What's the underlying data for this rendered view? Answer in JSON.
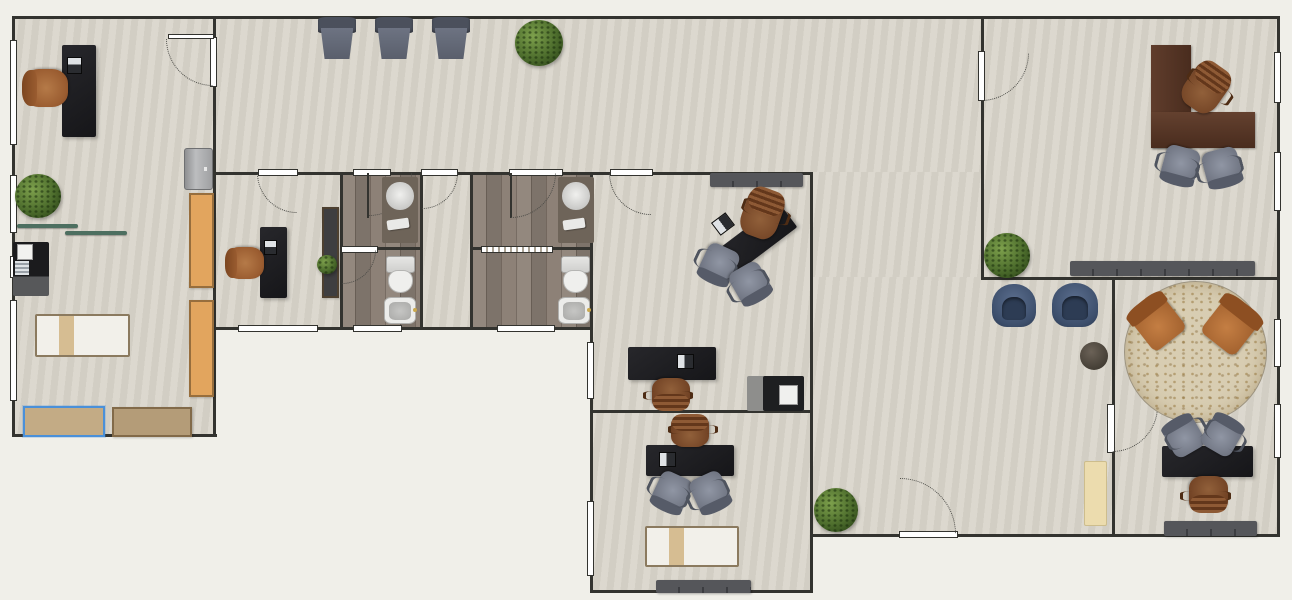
{
  "app": {
    "view": "floor-plan-2d"
  },
  "palette": {
    "exterior": "#f0efe9",
    "floor": "#d9d5cb",
    "bathroom_floor": "#8a7f76",
    "wall": "#33332f",
    "selection": "#4a90d9",
    "desk_black": "#1f1f22",
    "desk_wood": "#543325",
    "chair_cognac": "#9a5c30",
    "chair_gray": "#7d828e",
    "chair_blue": "#46587b",
    "plant_green": "#4c6c2c",
    "cabinet_orange": "#e2a55e",
    "cabinet_tan": "#b49c78"
  },
  "floorplan": {
    "canvas": {
      "w": 1292,
      "h": 600
    },
    "rooms": [
      {
        "n": "treatment-room",
        "x": 12,
        "y": 17,
        "w": 202,
        "h": 420,
        "floor": "default"
      },
      {
        "n": "hallway",
        "x": 214,
        "y": 17,
        "w": 767,
        "h": 156,
        "floor": "default"
      },
      {
        "n": "hallway-south",
        "x": 812,
        "y": 172,
        "w": 169,
        "h": 106,
        "floor": "default"
      },
      {
        "n": "waiting-area",
        "x": 812,
        "y": 277,
        "w": 300,
        "h": 258,
        "floor": "default"
      },
      {
        "n": "consultation-room",
        "x": 214,
        "y": 172,
        "w": 127,
        "h": 156,
        "floor": "default"
      },
      {
        "n": "bathroom-1",
        "x": 340,
        "y": 172,
        "w": 81,
        "h": 156,
        "floor": "wood"
      },
      {
        "n": "bathroom-lobby",
        "x": 420,
        "y": 172,
        "w": 51,
        "h": 156,
        "floor": "default"
      },
      {
        "n": "bathroom-2",
        "x": 471,
        "y": 172,
        "w": 120,
        "h": 156,
        "floor": "wood"
      },
      {
        "n": "office-center",
        "x": 590,
        "y": 172,
        "w": 221,
        "h": 239,
        "floor": "default"
      },
      {
        "n": "office-south",
        "x": 590,
        "y": 411,
        "w": 221,
        "h": 180,
        "floor": "default"
      },
      {
        "n": "office-northeast",
        "x": 981,
        "y": 19,
        "w": 297,
        "h": 259,
        "floor": "default"
      },
      {
        "n": "office-southeast",
        "x": 1112,
        "y": 277,
        "w": 166,
        "h": 258,
        "floor": "default"
      }
    ],
    "walls": [
      [
        12,
        16,
        1266,
        3
      ],
      [
        12,
        16,
        3,
        421
      ],
      [
        12,
        434,
        205,
        3
      ],
      [
        213,
        16,
        3,
        421
      ],
      [
        213,
        327,
        380,
        3
      ],
      [
        340,
        172,
        3,
        158
      ],
      [
        420,
        172,
        3,
        158
      ],
      [
        470,
        172,
        3,
        158
      ],
      [
        590,
        172,
        3,
        421
      ],
      [
        810,
        172,
        3,
        421
      ],
      [
        213,
        172,
        600,
        3
      ],
      [
        340,
        247,
        83,
        3
      ],
      [
        470,
        247,
        123,
        3
      ],
      [
        590,
        410,
        223,
        3
      ],
      [
        590,
        590,
        223,
        3
      ],
      [
        810,
        534,
        470,
        3
      ],
      [
        981,
        16,
        3,
        264
      ],
      [
        981,
        277,
        299,
        3
      ],
      [
        1112,
        277,
        3,
        260
      ],
      [
        1277,
        16,
        3,
        521
      ]
    ],
    "windows": [
      [
        10,
        40,
        7,
        105
      ],
      [
        10,
        175,
        7,
        58
      ],
      [
        10,
        256,
        7,
        22
      ],
      [
        10,
        300,
        7,
        101
      ],
      [
        238,
        325,
        80,
        7
      ],
      [
        353,
        325,
        49,
        7
      ],
      [
        497,
        325,
        58,
        7
      ],
      [
        587,
        342,
        7,
        57
      ],
      [
        587,
        501,
        7,
        75
      ],
      [
        1274,
        52,
        7,
        51
      ],
      [
        1274,
        152,
        7,
        59
      ],
      [
        1274,
        319,
        7,
        48
      ],
      [
        1274,
        404,
        7,
        54
      ]
    ],
    "doors": [
      {
        "n": "door-treatment-room",
        "bar": [
          210,
          37,
          7,
          50
        ],
        "leaf": [
          168,
          34,
          46,
          5,
          "light"
        ],
        "arc": [
          213,
          39,
          47,
          "bl"
        ]
      },
      {
        "n": "door-consultation",
        "bar": [
          258,
          169,
          40,
          7
        ],
        "arc": [
          297,
          173,
          40,
          "bl"
        ]
      },
      {
        "n": "door-bathroom-1",
        "bar": [
          353,
          169,
          38,
          7
        ],
        "leaf": [
          367,
          173,
          2,
          45,
          "dark"
        ],
        "arc": [
          369,
          173,
          43,
          "br"
        ]
      },
      {
        "n": "door-bathroom-lobby",
        "bar": [
          421,
          169,
          37,
          7
        ],
        "arc": [
          422,
          173,
          36,
          "br"
        ]
      },
      {
        "n": "door-bathroom-2",
        "bar": [
          509,
          169,
          54,
          7
        ],
        "leaf": [
          510,
          173,
          2,
          45,
          "dark"
        ],
        "arc": [
          511,
          173,
          45,
          "br"
        ]
      },
      {
        "n": "door-office-center",
        "bar": [
          610,
          169,
          43,
          7
        ],
        "arc": [
          651,
          173,
          42,
          "bl"
        ]
      },
      {
        "n": "door-office-northeast",
        "bar": [
          978,
          51,
          7,
          50
        ],
        "arc": [
          981,
          53,
          48,
          "br"
        ]
      },
      {
        "n": "door-office-southeast",
        "bar": [
          1107,
          404,
          8,
          49
        ],
        "arc": [
          1112,
          406,
          46,
          "br"
        ]
      },
      {
        "n": "door-entrance",
        "bar": [
          899,
          531,
          59,
          7
        ],
        "arc": [
          900,
          534,
          56,
          "tr"
        ]
      },
      {
        "n": "door-bathroom-1-inner",
        "bar": [
          341,
          246,
          37,
          7
        ],
        "arc": [
          342,
          250,
          34,
          "br"
        ]
      },
      {
        "n": "sliding-door-bathroom-2",
        "bar": [
          481,
          246,
          72,
          7
        ],
        "slider": true
      }
    ],
    "furniture": [
      {
        "t": "desk",
        "n": "desk",
        "x": 62,
        "y": 45,
        "w": 34,
        "h": 92
      },
      {
        "t": "laptop",
        "n": "laptop",
        "x": 66,
        "y": 58,
        "w": 17,
        "h": 15,
        "r": 90
      },
      {
        "t": "chair-task",
        "n": "office-chair",
        "x": 28,
        "y": 67,
        "w": 38,
        "h": 42,
        "r": -90
      },
      {
        "t": "plant",
        "n": "plant",
        "x": 15,
        "y": 174,
        "w": 46,
        "h": 44
      },
      {
        "t": "shelf",
        "n": "wall-shelf",
        "x": 17,
        "y": 224,
        "w": 61,
        "h": 4
      },
      {
        "t": "shelf",
        "n": "wall-shelf",
        "x": 65,
        "y": 231,
        "w": 62,
        "h": 4
      },
      {
        "t": "kitchenette",
        "n": "kitchenette",
        "x": 13,
        "y": 242,
        "w": 36,
        "h": 54
      },
      {
        "t": "bed",
        "n": "exam-bed",
        "x": 35,
        "y": 314,
        "w": 95,
        "h": 43
      },
      {
        "t": "cabinet",
        "n": "cabinet-selected",
        "x": 23,
        "y": 406,
        "w": 82,
        "h": 31,
        "c": "#c3ab85",
        "sel": true
      },
      {
        "t": "cabinet",
        "n": "cabinet",
        "x": 112,
        "y": 407,
        "w": 80,
        "h": 30,
        "c": "#b49c78"
      },
      {
        "t": "fridge",
        "n": "mini-fridge",
        "x": 184,
        "y": 148,
        "w": 29,
        "h": 42
      },
      {
        "t": "cabinet",
        "n": "tall-cabinet",
        "x": 189,
        "y": 193,
        "w": 25,
        "h": 95,
        "c": "#e2a55e"
      },
      {
        "t": "cabinet",
        "n": "tall-cabinet",
        "x": 189,
        "y": 300,
        "w": 25,
        "h": 97,
        "c": "#e2a55e"
      },
      {
        "t": "armchair",
        "n": "recliner-chair",
        "x": 318,
        "y": 17,
        "w": 38,
        "h": 42
      },
      {
        "t": "armchair",
        "n": "recliner-chair",
        "x": 375,
        "y": 17,
        "w": 38,
        "h": 42
      },
      {
        "t": "armchair",
        "n": "recliner-chair",
        "x": 432,
        "y": 17,
        "w": 38,
        "h": 42
      },
      {
        "t": "plant",
        "n": "plant",
        "x": 515,
        "y": 20,
        "w": 48,
        "h": 46
      },
      {
        "t": "desk",
        "n": "desk",
        "x": 260,
        "y": 227,
        "w": 27,
        "h": 71
      },
      {
        "t": "laptop",
        "n": "laptop",
        "x": 263,
        "y": 241,
        "w": 15,
        "h": 13,
        "r": 90
      },
      {
        "t": "chair-task",
        "n": "office-chair",
        "x": 230,
        "y": 245,
        "w": 32,
        "h": 36,
        "r": -90
      },
      {
        "t": "cabinet",
        "n": "storage-cabinet",
        "x": 322,
        "y": 207,
        "w": 17,
        "h": 91,
        "c": "#3e3e40"
      },
      {
        "t": "plant",
        "n": "small-plant",
        "x": 317,
        "y": 255,
        "w": 20,
        "h": 19
      },
      {
        "t": "vanity",
        "n": "vanity-sink",
        "x": 382,
        "y": 177,
        "w": 36,
        "h": 66
      },
      {
        "t": "toilet",
        "n": "toilet",
        "x": 384,
        "y": 256,
        "w": 31,
        "h": 36
      },
      {
        "t": "bidet",
        "n": "bidet",
        "x": 384,
        "y": 297,
        "w": 32,
        "h": 27
      },
      {
        "t": "vanity",
        "n": "vanity-sink",
        "x": 558,
        "y": 177,
        "w": 36,
        "h": 66
      },
      {
        "t": "toilet",
        "n": "toilet",
        "x": 559,
        "y": 256,
        "w": 31,
        "h": 36
      },
      {
        "t": "bidet",
        "n": "bidet",
        "x": 558,
        "y": 297,
        "w": 32,
        "h": 27
      },
      {
        "t": "sideboard",
        "n": "sideboard",
        "x": 710,
        "y": 173,
        "w": 93,
        "h": 14
      },
      {
        "t": "desk",
        "n": "desk-angled",
        "x": 702,
        "y": 229,
        "w": 96,
        "h": 30,
        "r": -37
      },
      {
        "t": "laptop",
        "n": "laptop",
        "x": 714,
        "y": 216,
        "w": 18,
        "h": 16,
        "r": -37
      },
      {
        "t": "chair-exec",
        "n": "executive-chair",
        "x": 743,
        "y": 190,
        "w": 38,
        "h": 48,
        "r": 20
      },
      {
        "t": "chair-visitor",
        "n": "visitor-chair",
        "x": 702,
        "y": 246,
        "w": 34,
        "h": 36,
        "r": 205
      },
      {
        "t": "chair-visitor",
        "n": "visitor-chair",
        "x": 733,
        "y": 265,
        "w": 34,
        "h": 36,
        "r": 150
      },
      {
        "t": "desk",
        "n": "desk",
        "x": 628,
        "y": 347,
        "w": 88,
        "h": 33
      },
      {
        "t": "laptop",
        "n": "laptop",
        "x": 677,
        "y": 354,
        "w": 17,
        "h": 15
      },
      {
        "t": "chair-exec",
        "n": "executive-chair",
        "x": 652,
        "y": 378,
        "w": 38,
        "h": 31,
        "r": 180
      },
      {
        "t": "printer",
        "n": "printer",
        "x": 747,
        "y": 376,
        "w": 57,
        "h": 35
      },
      {
        "t": "desk",
        "n": "desk",
        "x": 646,
        "y": 445,
        "w": 88,
        "h": 31
      },
      {
        "t": "laptop",
        "n": "laptop",
        "x": 659,
        "y": 452,
        "w": 17,
        "h": 15
      },
      {
        "t": "chair-exec",
        "n": "executive-chair",
        "x": 671,
        "y": 416,
        "w": 38,
        "h": 31
      },
      {
        "t": "chair-visitor",
        "n": "visitor-chair",
        "x": 655,
        "y": 474,
        "w": 34,
        "h": 36,
        "r": 205
      },
      {
        "t": "chair-visitor",
        "n": "visitor-chair",
        "x": 693,
        "y": 474,
        "w": 34,
        "h": 36,
        "r": 155
      },
      {
        "t": "bed",
        "n": "exam-bed",
        "x": 645,
        "y": 526,
        "w": 94,
        "h": 41
      },
      {
        "t": "sideboard",
        "n": "sideboard",
        "x": 656,
        "y": 580,
        "w": 95,
        "h": 13
      },
      {
        "t": "plant",
        "n": "plant",
        "x": 814,
        "y": 488,
        "w": 44,
        "h": 44
      },
      {
        "t": "tub-chair",
        "n": "tub-chair",
        "x": 992,
        "y": 284,
        "w": 44,
        "h": 43
      },
      {
        "t": "tub-chair",
        "n": "tub-chair",
        "x": 1052,
        "y": 283,
        "w": 46,
        "h": 44
      },
      {
        "t": "side-table",
        "n": "side-table",
        "x": 1080,
        "y": 342,
        "w": 28,
        "h": 28
      },
      {
        "t": "mat",
        "n": "floor-mat",
        "x": 1084,
        "y": 461,
        "w": 23,
        "h": 65
      },
      {
        "t": "rug",
        "n": "round-rug",
        "x": 1124,
        "y": 281,
        "w": 143,
        "h": 142
      },
      {
        "t": "lounge-chair",
        "n": "lounge-chair",
        "x": 1137,
        "y": 300,
        "w": 41,
        "h": 45,
        "r": -38
      },
      {
        "t": "lounge-chair",
        "n": "lounge-chair",
        "x": 1209,
        "y": 303,
        "w": 43,
        "h": 46,
        "r": 38
      },
      {
        "t": "desk",
        "n": "desk",
        "x": 1162,
        "y": 446,
        "w": 91,
        "h": 31
      },
      {
        "t": "chair-visitor",
        "n": "visitor-chair",
        "x": 1167,
        "y": 419,
        "w": 34,
        "h": 35,
        "r": -30
      },
      {
        "t": "chair-visitor",
        "n": "visitor-chair",
        "x": 1205,
        "y": 418,
        "w": 34,
        "h": 35,
        "r": 30
      },
      {
        "t": "chair-exec",
        "n": "executive-chair",
        "x": 1189,
        "y": 476,
        "w": 39,
        "h": 35,
        "r": 180
      },
      {
        "t": "sideboard",
        "n": "sideboard",
        "x": 1164,
        "y": 521,
        "w": 93,
        "h": 15
      },
      {
        "t": "wdesk-l",
        "n": "l-shaped-desk",
        "x": 1151,
        "y": 45,
        "w": 104,
        "h": 103
      },
      {
        "t": "chair-exec",
        "n": "executive-chair",
        "x": 1186,
        "y": 64,
        "w": 39,
        "h": 48,
        "r": 35
      },
      {
        "t": "chair-visitor",
        "n": "visitor-chair",
        "x": 1163,
        "y": 147,
        "w": 35,
        "h": 36,
        "r": 195
      },
      {
        "t": "chair-visitor",
        "n": "visitor-chair",
        "x": 1204,
        "y": 149,
        "w": 36,
        "h": 36,
        "r": 165
      },
      {
        "t": "sideboard",
        "n": "sideboard",
        "x": 1070,
        "y": 261,
        "w": 185,
        "h": 15
      },
      {
        "t": "plant",
        "n": "plant",
        "x": 984,
        "y": 233,
        "w": 46,
        "h": 45
      }
    ]
  }
}
